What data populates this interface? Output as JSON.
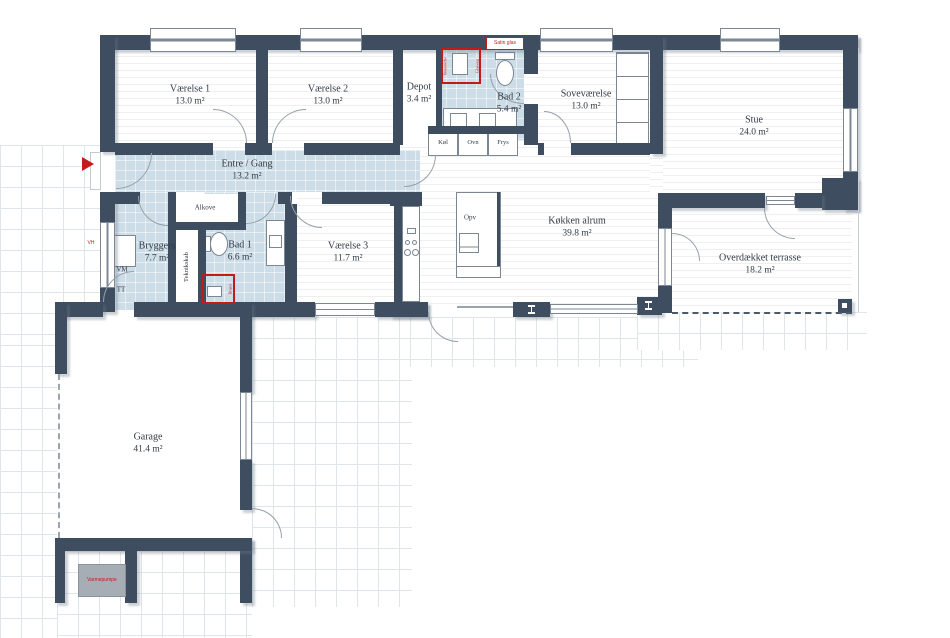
{
  "plan": {
    "type": "floor-plan",
    "rooms": [
      {
        "name": "Værelse 1",
        "area": "13.0 m²"
      },
      {
        "name": "Værelse 2",
        "area": "13.0 m²"
      },
      {
        "name": "Depot",
        "area": "3.4 m²"
      },
      {
        "name": "Bad 2",
        "area": "5.4 m²"
      },
      {
        "name": "Soveværelse",
        "area": "13.0 m²"
      },
      {
        "name": "Stue",
        "area": "24.0 m²"
      },
      {
        "name": "Entre / Gang",
        "area": "13.2 m²"
      },
      {
        "name": "Bryggers",
        "area": "7.7 m²"
      },
      {
        "name": "Bad 1",
        "area": "6.6 m²"
      },
      {
        "name": "Værelse 3",
        "area": "11.7 m²"
      },
      {
        "name": "Køkken alrum",
        "area": "39.8 m²"
      },
      {
        "name": "Overdækket terrasse",
        "area": "18.2 m²"
      },
      {
        "name": "Garage",
        "area": "41.4 m²"
      }
    ],
    "closets": {
      "alkove": "Alkove",
      "teknikskab": "Teknikskab"
    },
    "appliances": {
      "koel": "Køl",
      "ovn": "Ovn",
      "frys": "Frys",
      "opv": "Opv",
      "vm": "VM",
      "tt": "TT"
    },
    "annotations": {
      "varmepumpe": "Varmepumpe",
      "satin_glas": "Satin glas",
      "bad2_shower_side": "Bruseniche",
      "bad2_shower_glass": "Glasvæg",
      "bad1_shower": "Bruser",
      "outdoor_tap": "VH"
    },
    "colors": {
      "wall": "#3e4e60",
      "wet_room": "#cddde7",
      "annotation": "#c51a1a"
    }
  }
}
